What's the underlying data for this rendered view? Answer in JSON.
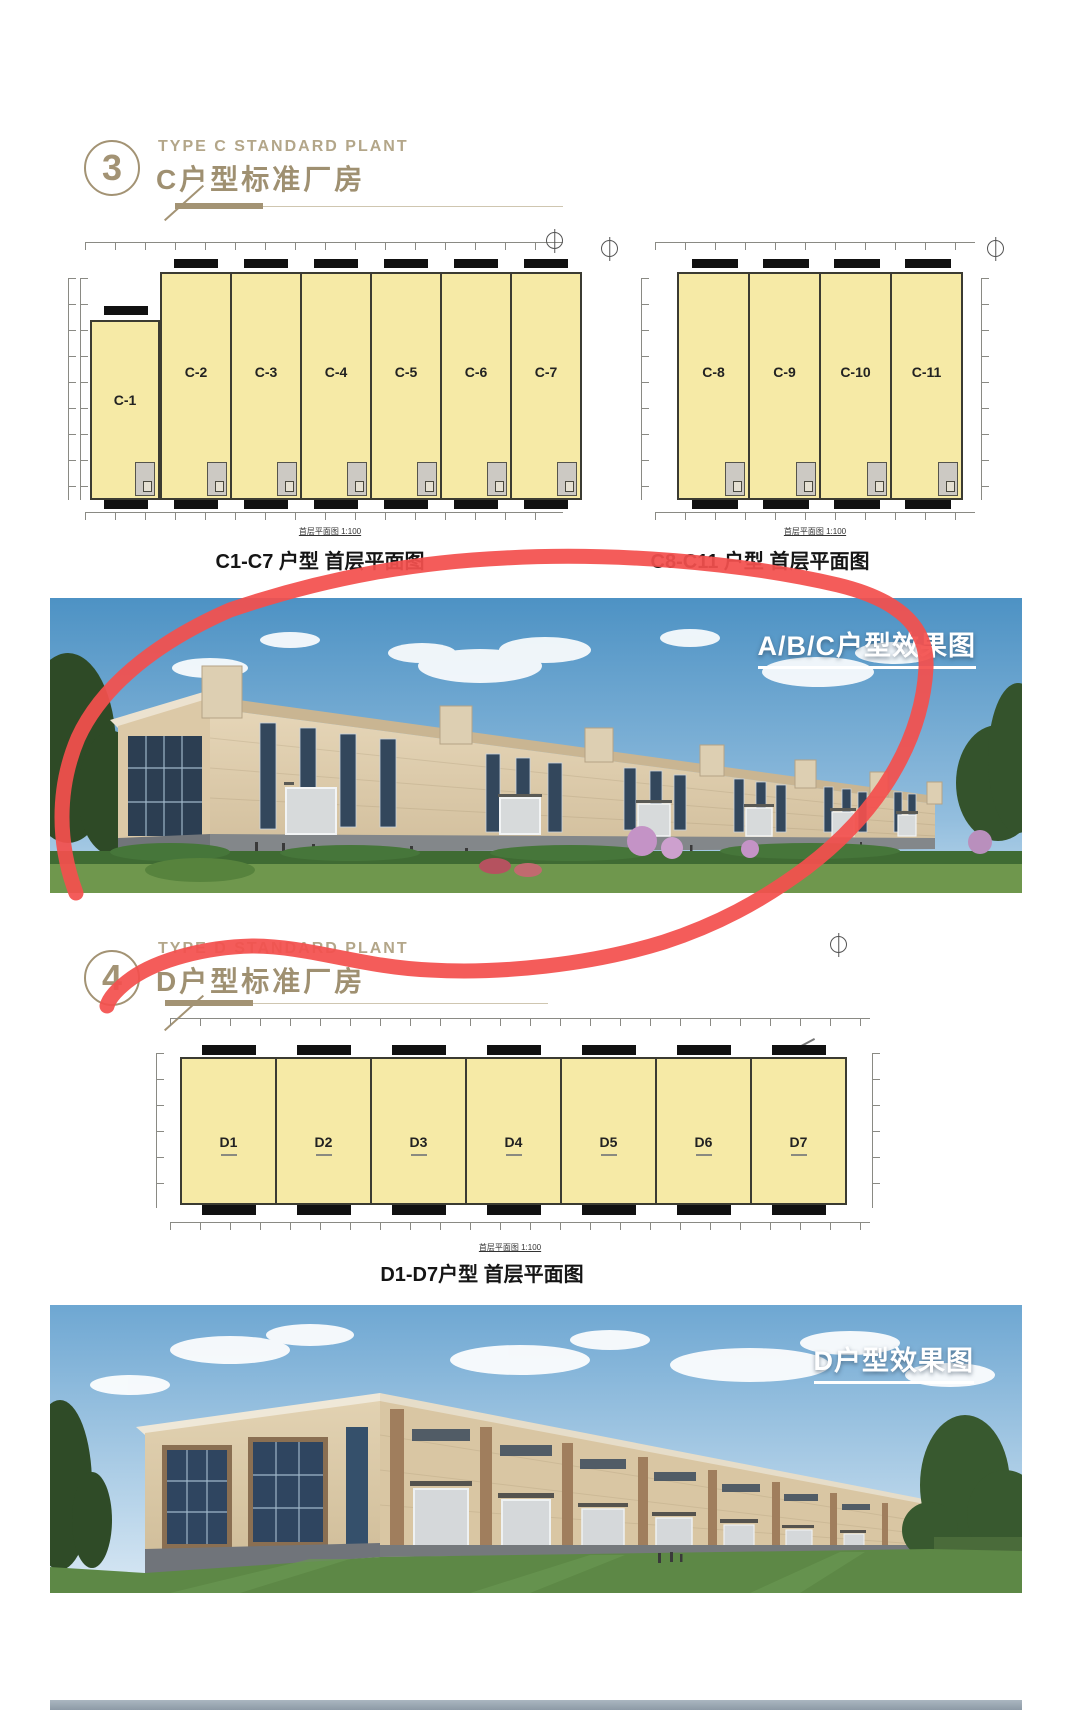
{
  "colors": {
    "accent_gold": "#a39374",
    "marker_red": "#f3504e",
    "plan_yellow": "#f6eaa6",
    "photo_label_white": "#ffffff"
  },
  "section3": {
    "number": "3",
    "title_en": "TYPE C STANDARD PLANT",
    "title_cn": "C户型标准厂房"
  },
  "section4": {
    "number": "4",
    "title_en": "TYPE D STANDARD PLANT",
    "title_cn": "D户型标准厂房"
  },
  "plans": {
    "c17": {
      "units": [
        "C-1",
        "C-2",
        "C-3",
        "C-4",
        "C-5",
        "C-6",
        "C-7"
      ],
      "scale_note": "首层平面图 1:100",
      "caption": "C1-C7 户型 首层平面图"
    },
    "c811": {
      "units": [
        "C-8",
        "C-9",
        "C-10",
        "C-11"
      ],
      "scale_note": "首层平面图 1:100",
      "caption": "C8-C11 户型 首层平面图"
    },
    "d": {
      "units": [
        "D1",
        "D2",
        "D3",
        "D4",
        "D5",
        "D6",
        "D7"
      ],
      "scale_note": "首层平面图 1:100",
      "caption": "D1-D7户型 首层平面图"
    }
  },
  "photos": {
    "abc": {
      "label": "A/B/C户型效果图"
    },
    "d": {
      "label": "D户型效果图"
    }
  },
  "annotation": {
    "description": "hand-drawn red marker loop circling the A/B/C rendering",
    "color": "#f3504e"
  }
}
